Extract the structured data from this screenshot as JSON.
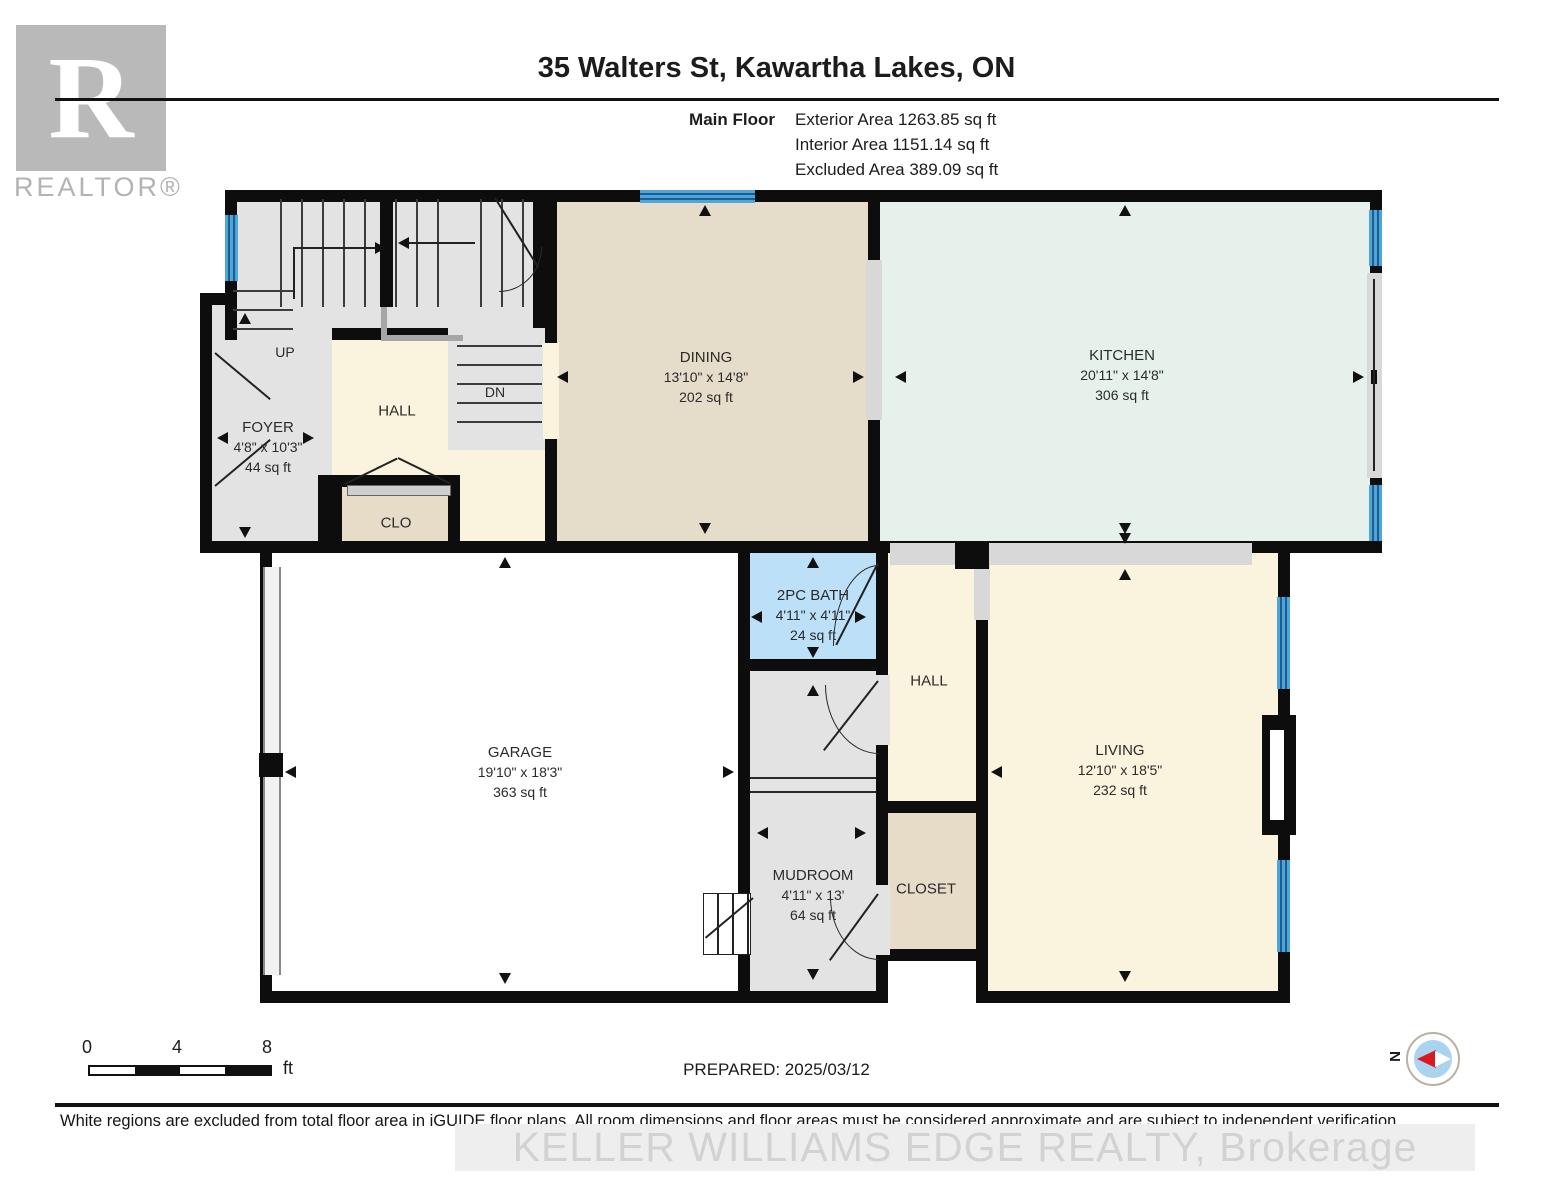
{
  "header": {
    "logo_letter": "R",
    "logo_word": "REALTOR®",
    "title": "35 Walters St, Kawartha Lakes, ON",
    "floor_label": "Main Floor",
    "areas": [
      "Exterior Area 1263.85 sq ft",
      "Interior Area 1151.14 sq ft",
      "Excluded Area 389.09 sq ft"
    ]
  },
  "rooms": {
    "foyer": {
      "name": "FOYER",
      "dims": "4'8\" x 10'3\"",
      "area": "44 sq ft"
    },
    "hall_upper": {
      "name": "HALL"
    },
    "closet_upper": {
      "name": "CLO"
    },
    "dining": {
      "name": "DINING",
      "dims": "13'10\" x 14'8\"",
      "area": "202 sq ft"
    },
    "kitchen": {
      "name": "KITCHEN",
      "dims": "20'11\" x 14'8\"",
      "area": "306 sq ft"
    },
    "bath": {
      "name": "2PC BATH",
      "dims": "4'11\" x 4'11\"",
      "area": "24 sq ft"
    },
    "hall_lower": {
      "name": "HALL"
    },
    "garage": {
      "name": "GARAGE",
      "dims": "19'10\" x 18'3\"",
      "area": "363 sq ft"
    },
    "mudroom": {
      "name": "MUDROOM",
      "dims": "4'11\" x 13'",
      "area": "64 sq ft"
    },
    "closet_lower": {
      "name": "CLOSET"
    },
    "living": {
      "name": "LIVING",
      "dims": "12'10\" x 18'5\"",
      "area": "232 sq ft"
    },
    "stairs": {
      "up": "UP",
      "down": "DN"
    }
  },
  "footer": {
    "scale": {
      "start": "0",
      "mid": "4",
      "end": "8",
      "unit": "ft"
    },
    "prepared": "PREPARED: 2025/03/12",
    "compass_label": "N",
    "disclaimer": "White regions are excluded from total floor area in iGUIDE floor plans. All room dimensions and floor areas must be considered approximate and are subject to independent verification.",
    "watermark": "KELLER WILLIAMS EDGE REALTY, Brokerage"
  },
  "colors": {
    "wall": "#0d0d0d",
    "stair_gray": "#e3e3e3",
    "hall_cream": "#faf3dd",
    "dining_tan": "#e5dcc9",
    "kitchen_green": "#e7f1eb",
    "bath_blue": "#bce0f8",
    "window_blue": "#4fa5d8",
    "compass_red": "#d71920"
  }
}
